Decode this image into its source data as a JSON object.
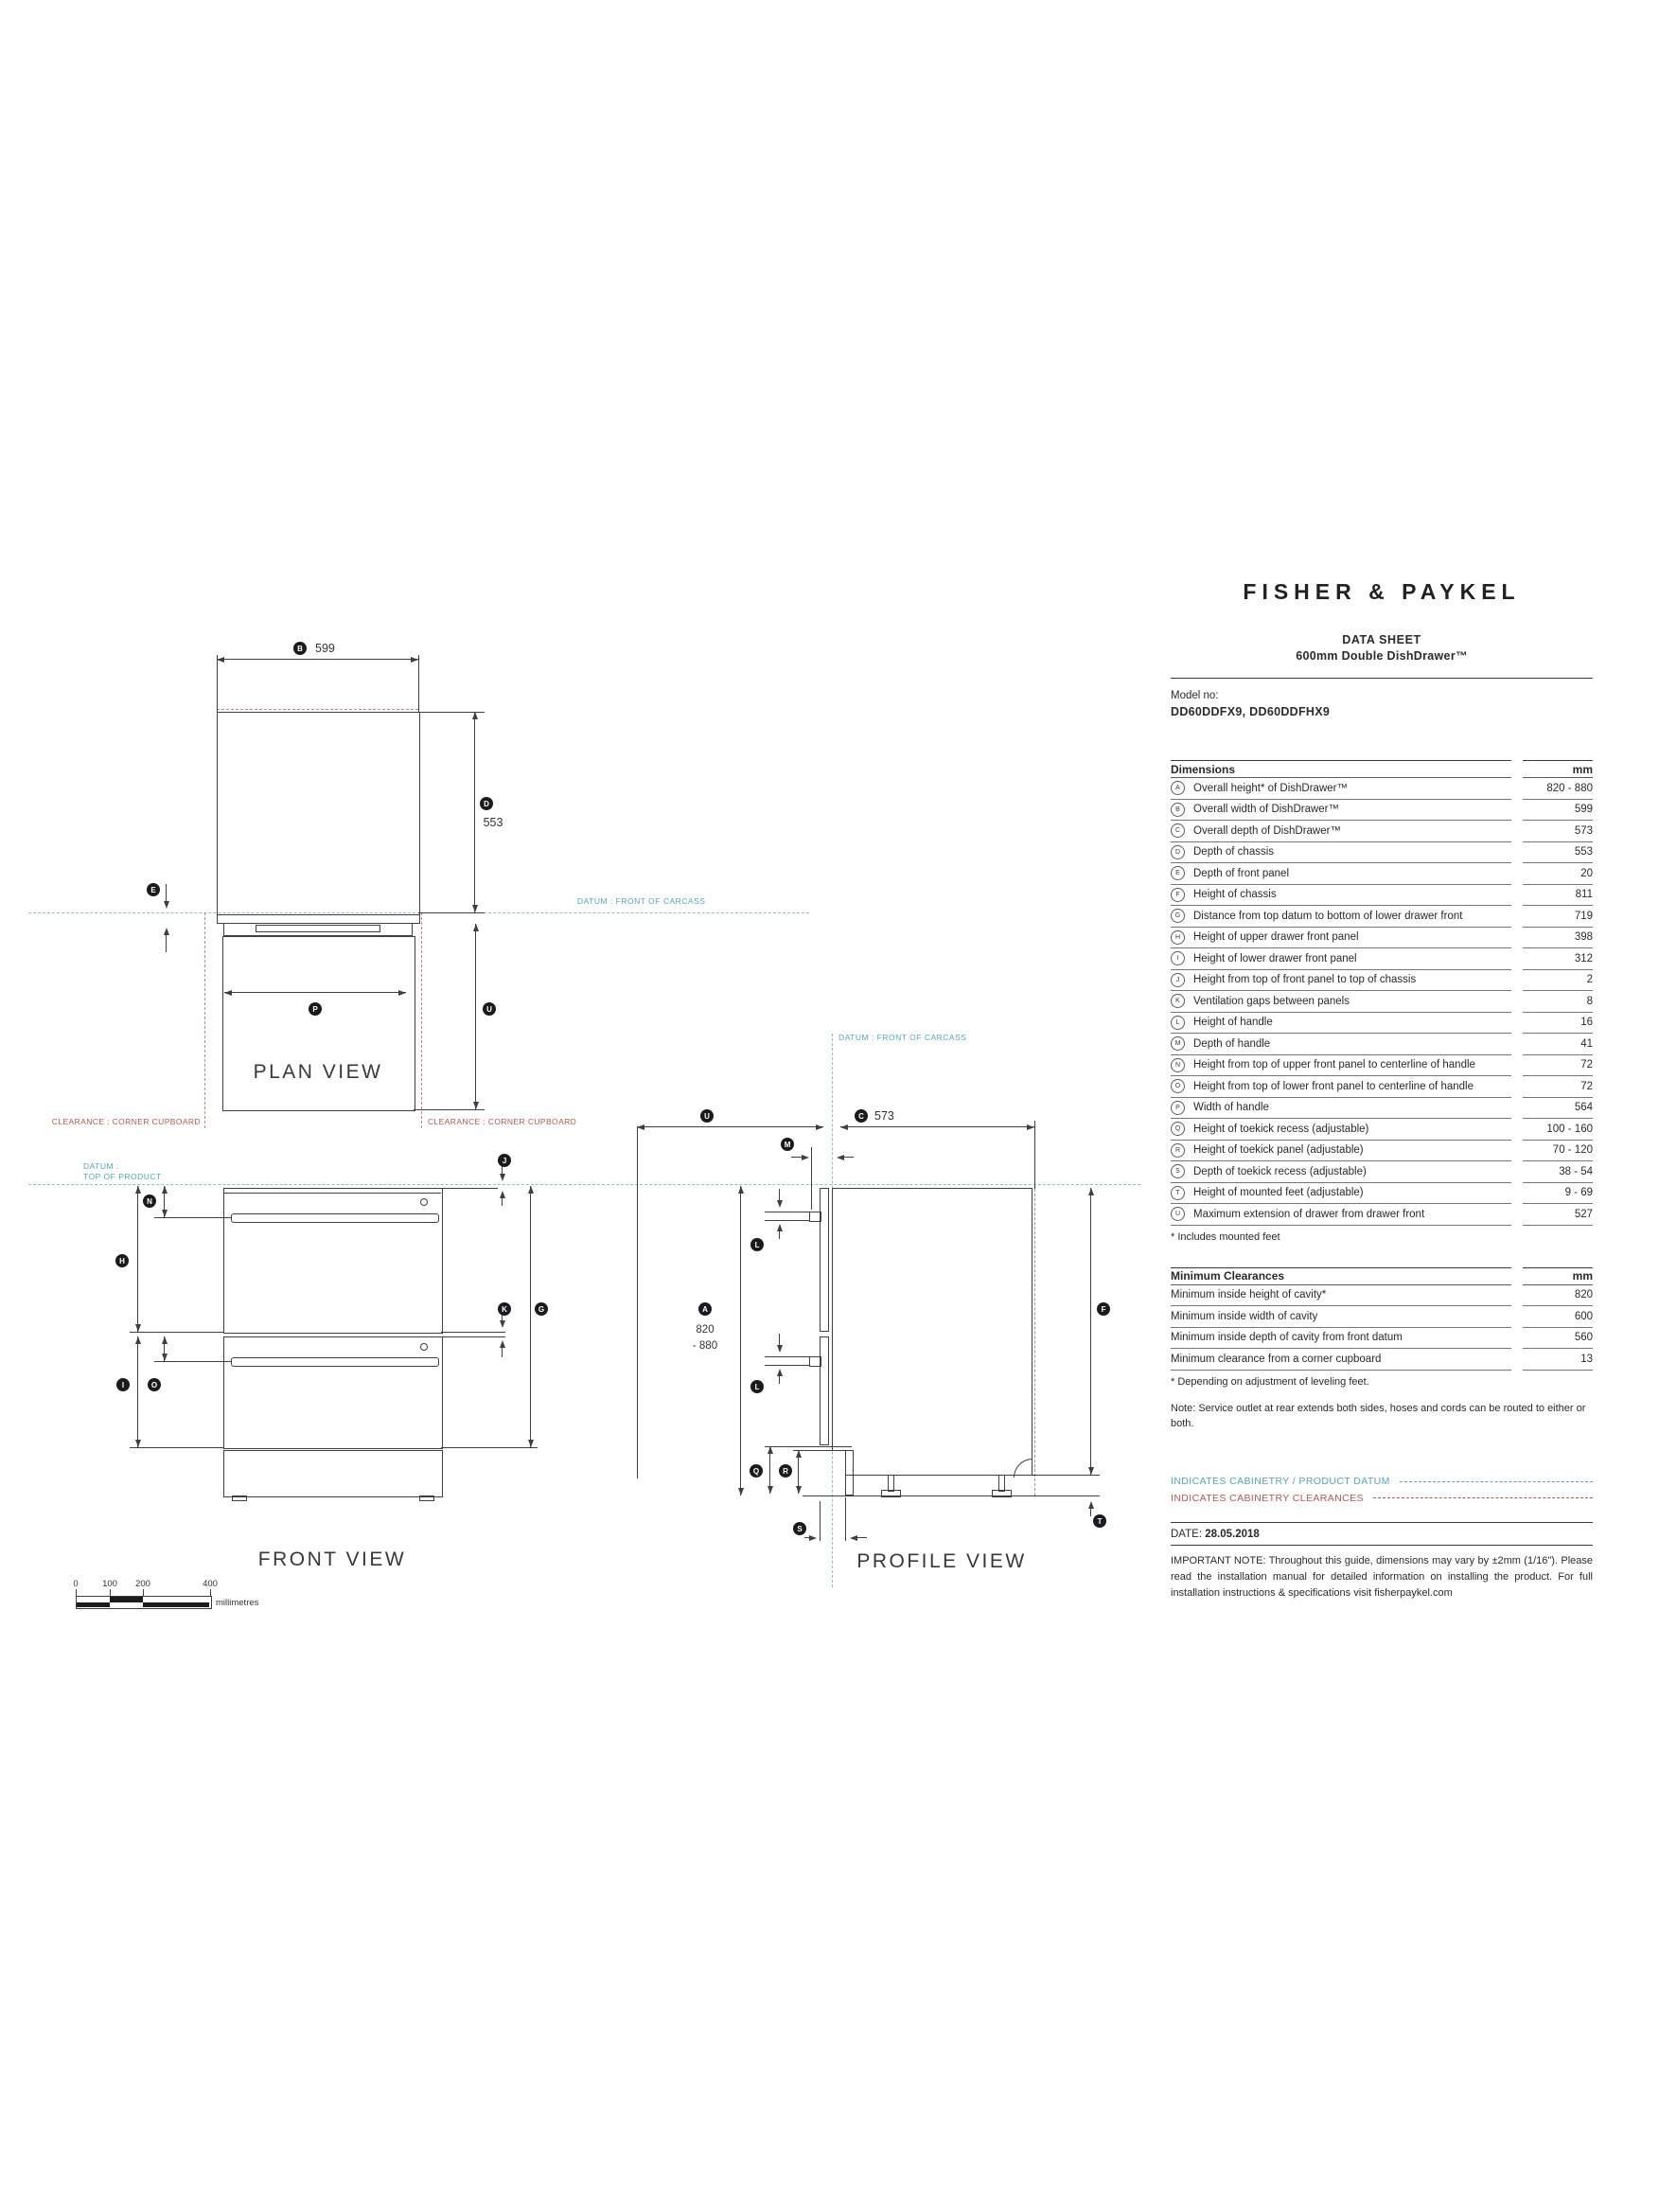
{
  "header": {
    "brand": "FISHER & PAYKEL",
    "doc_title": "DATA SHEET",
    "product": "600mm Double DishDrawer™",
    "model_label": "Model no:",
    "model_numbers": "DD60DDFX9, DD60DDFHX9"
  },
  "dimensions_table": {
    "title": "Dimensions",
    "unit": "mm",
    "rows": [
      {
        "key": "A",
        "label": "Overall height* of DishDrawer™",
        "value": "820 - 880"
      },
      {
        "key": "B",
        "label": "Overall width of DishDrawer™",
        "value": "599"
      },
      {
        "key": "C",
        "label": "Overall depth of DishDrawer™",
        "value": "573"
      },
      {
        "key": "D",
        "label": "Depth of chassis",
        "value": "553"
      },
      {
        "key": "E",
        "label": "Depth of front panel",
        "value": "20"
      },
      {
        "key": "F",
        "label": "Height of chassis",
        "value": "811"
      },
      {
        "key": "G",
        "label": "Distance from top datum to bottom of lower drawer front",
        "value": "719"
      },
      {
        "key": "H",
        "label": "Height of upper drawer front panel",
        "value": "398"
      },
      {
        "key": "I",
        "label": "Height of lower drawer front panel",
        "value": "312"
      },
      {
        "key": "J",
        "label": "Height from top of front panel to top of chassis",
        "value": "2"
      },
      {
        "key": "K",
        "label": "Ventilation gaps between panels",
        "value": "8"
      },
      {
        "key": "L",
        "label": "Height of handle",
        "value": "16"
      },
      {
        "key": "M",
        "label": "Depth of handle",
        "value": "41"
      },
      {
        "key": "N",
        "label": "Height from top of upper front panel to centerline of handle",
        "value": "72"
      },
      {
        "key": "O",
        "label": "Height from top of lower front panel to centerline of handle",
        "value": "72"
      },
      {
        "key": "P",
        "label": "Width of handle",
        "value": "564"
      },
      {
        "key": "Q",
        "label": "Height of toekick recess (adjustable)",
        "value": "100 - 160"
      },
      {
        "key": "R",
        "label": "Height of toekick panel (adjustable)",
        "value": "70 - 120"
      },
      {
        "key": "S",
        "label": "Depth of toekick recess (adjustable)",
        "value": "38 - 54"
      },
      {
        "key": "T",
        "label": "Height of mounted feet (adjustable)",
        "value": "9 - 69"
      },
      {
        "key": "U",
        "label": "Maximum extension of drawer from drawer front",
        "value": "527"
      }
    ],
    "footnote": "* Includes mounted feet"
  },
  "clearances_table": {
    "title": "Minimum Clearances",
    "unit": "mm",
    "rows": [
      {
        "label": "Minimum inside height of cavity*",
        "value": "820"
      },
      {
        "label": "Minimum inside width of cavity",
        "value": "600"
      },
      {
        "label": "Minimum inside depth of cavity from front datum",
        "value": "560"
      },
      {
        "label": "Minimum clearance from a corner cupboard",
        "value": "13"
      }
    ],
    "footnote": "* Depending on adjustment of leveling feet.",
    "note": "Note: Service outlet at rear extends both sides, hoses and cords can be routed to either or both."
  },
  "legend": {
    "datum_label": "INDICATES CABINETRY / PRODUCT DATUM",
    "clearance_label": "INDICATES CABINETRY CLEARANCES"
  },
  "footer": {
    "date_label": "DATE:",
    "date_value": "28.05.2018",
    "important_note": "IMPORTANT NOTE: Throughout this guide, dimensions may vary by ±2mm (1/16\"). Please read the installation manual for detailed information on installing the product. For full installation instructions & specifications visit fisherpaykel.com"
  },
  "drawing": {
    "plan_title": "PLAN VIEW",
    "front_title": "FRONT VIEW",
    "profile_title": "PROFILE VIEW",
    "datum_front_of_carcass": "DATUM : FRONT OF CARCASS",
    "datum_top_line1": "DATUM :",
    "datum_top_line2": "TOP OF PRODUCT",
    "clearance_corner_cupboard": "CLEARANCE : CORNER CUPBOARD",
    "dim_A1": "820",
    "dim_A2": "- 880",
    "scale_ticks": [
      "0",
      "100",
      "200",
      "400"
    ],
    "scale_unit": "millimetres"
  },
  "colors": {
    "line": "#3f3f42",
    "datum_teal": "#4fa7bd",
    "datum_dash": "#8ebecd",
    "clearance_red": "#b4584f",
    "clearance_dash": "#cc837b",
    "service_gray": "#9a9a9a"
  }
}
